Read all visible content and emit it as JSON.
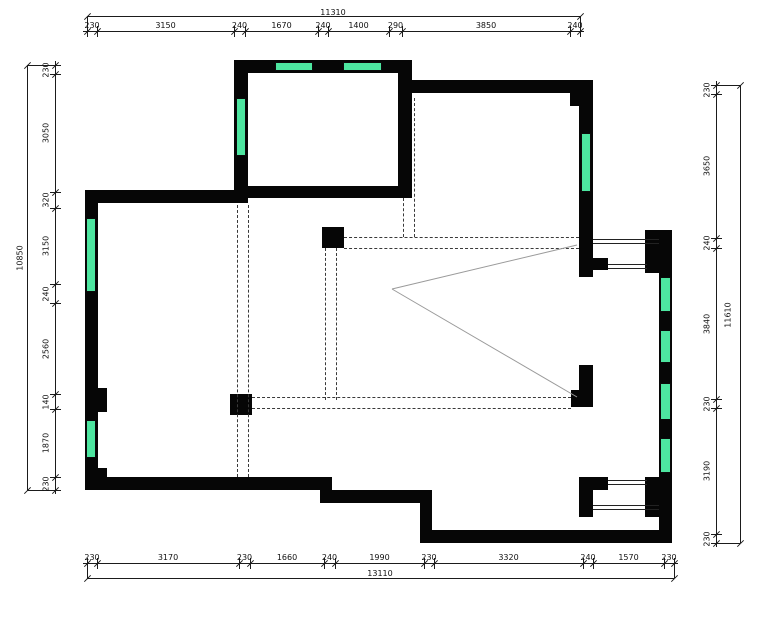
{
  "drawing": {
    "kind": "architectural-floor-plan"
  },
  "colors": {
    "wall": "#060606",
    "window_fill": "#4DE6A0",
    "dashed_line": "#3a3a3a",
    "thin_line": "#9a9a9a",
    "dimension": "#1b1b1b",
    "background": "#ffffff"
  },
  "dimensions": {
    "top": {
      "overall_label": "11310",
      "labels": [
        "230",
        "3150",
        "240",
        "1670",
        "240",
        "1400",
        "290",
        "3850",
        "240"
      ]
    },
    "bottom": {
      "overall_label": "13110",
      "labels": [
        "230",
        "3170",
        "230",
        "1660",
        "240",
        "1990",
        "230",
        "3320",
        "240",
        "1570",
        "230"
      ]
    },
    "left": {
      "overall_label": "10850",
      "labels": [
        "230",
        "3050",
        "320",
        "3150",
        "240",
        "2560",
        "140",
        "1870",
        "230"
      ]
    },
    "right": {
      "overall_label": "11610",
      "labels": [
        "230",
        "3650",
        "240",
        "3840",
        "230",
        "3190",
        "230"
      ]
    }
  },
  "layout": {
    "dims": {
      "top": {
        "axis": "h",
        "seg": 31,
        "ov": 16,
        "a": 87,
        "b": 580,
        "ticks": [
          87,
          97,
          234,
          245,
          318,
          328,
          389,
          402,
          570,
          580
        ],
        "overall_pos": [
          333,
          8
        ]
      },
      "bottom": {
        "axis": "h",
        "seg": 563,
        "ov": 578,
        "a": 87,
        "b": 674,
        "ticks": [
          87,
          97,
          239,
          250,
          324,
          335,
          424,
          434,
          583,
          593,
          664,
          674
        ],
        "overall_pos": [
          380,
          569
        ]
      },
      "left": {
        "axis": "v",
        "seg": 55,
        "ov": 27,
        "a": 65,
        "b": 490,
        "ticks": [
          65,
          74,
          192,
          208,
          284,
          303,
          394,
          409,
          477,
          490
        ],
        "overall_pos": [
          20,
          258
        ]
      },
      "right": {
        "axis": "v",
        "seg": 716,
        "ov": 740,
        "a": 85,
        "b": 543,
        "ticks": [
          85,
          94,
          238,
          248,
          399,
          408,
          534,
          543
        ],
        "overall_pos": [
          728,
          315
        ]
      }
    }
  },
  "geometry": {
    "walls": [
      [
        234,
        60,
        178,
        13
      ],
      [
        234,
        60,
        14,
        143
      ],
      [
        248,
        186,
        164,
        12
      ],
      [
        398,
        60,
        14,
        138
      ],
      [
        398,
        80,
        195,
        13
      ],
      [
        579,
        80,
        14,
        158
      ],
      [
        570,
        93,
        9,
        13
      ],
      [
        85,
        190,
        163,
        13
      ],
      [
        85,
        190,
        13,
        300
      ],
      [
        98,
        388,
        9,
        24
      ],
      [
        98,
        468,
        9,
        10
      ],
      [
        85,
        477,
        247,
        13
      ],
      [
        320,
        477,
        12,
        26
      ],
      [
        320,
        490,
        112,
        13
      ],
      [
        420,
        503,
        12,
        40
      ],
      [
        420,
        530,
        252,
        13
      ],
      [
        659,
        230,
        13,
        313
      ],
      [
        645,
        230,
        27,
        43
      ],
      [
        579,
        238,
        14,
        39
      ],
      [
        593,
        258,
        15,
        12
      ],
      [
        579,
        365,
        14,
        32
      ],
      [
        571,
        390,
        22,
        17
      ],
      [
        579,
        477,
        14,
        40
      ],
      [
        645,
        477,
        27,
        40
      ],
      [
        593,
        477,
        15,
        13
      ]
    ],
    "windows": [
      [
        275,
        62,
        38,
        9
      ],
      [
        343,
        62,
        39,
        9
      ],
      [
        236,
        98,
        10,
        58
      ],
      [
        581,
        133,
        10,
        59
      ],
      [
        86,
        218,
        10,
        74
      ],
      [
        86,
        420,
        10,
        38
      ],
      [
        660,
        277,
        11,
        35
      ],
      [
        660,
        330,
        11,
        33
      ],
      [
        660,
        383,
        11,
        37
      ],
      [
        660,
        438,
        11,
        35
      ]
    ],
    "columns": [
      [
        322,
        227,
        22,
        21
      ],
      [
        230,
        394,
        22,
        21
      ]
    ],
    "dashed_v": [
      [
        237,
        205,
        477
      ],
      [
        248,
        205,
        477
      ],
      [
        325,
        248,
        400
      ],
      [
        336,
        248,
        400
      ],
      [
        414,
        98,
        237
      ],
      [
        403,
        198,
        237
      ]
    ],
    "dashed_h": [
      [
        237,
        344,
        579
      ],
      [
        248,
        344,
        579
      ],
      [
        397,
        252,
        571
      ],
      [
        408,
        252,
        571
      ]
    ],
    "bays": [
      [
        593,
        239,
        66
      ],
      [
        608,
        264,
        39
      ],
      [
        608,
        480,
        39
      ],
      [
        593,
        505,
        66
      ]
    ],
    "diagonals": [
      [
        392,
        289,
        577,
        245
      ],
      [
        392,
        289,
        577,
        397
      ]
    ]
  }
}
